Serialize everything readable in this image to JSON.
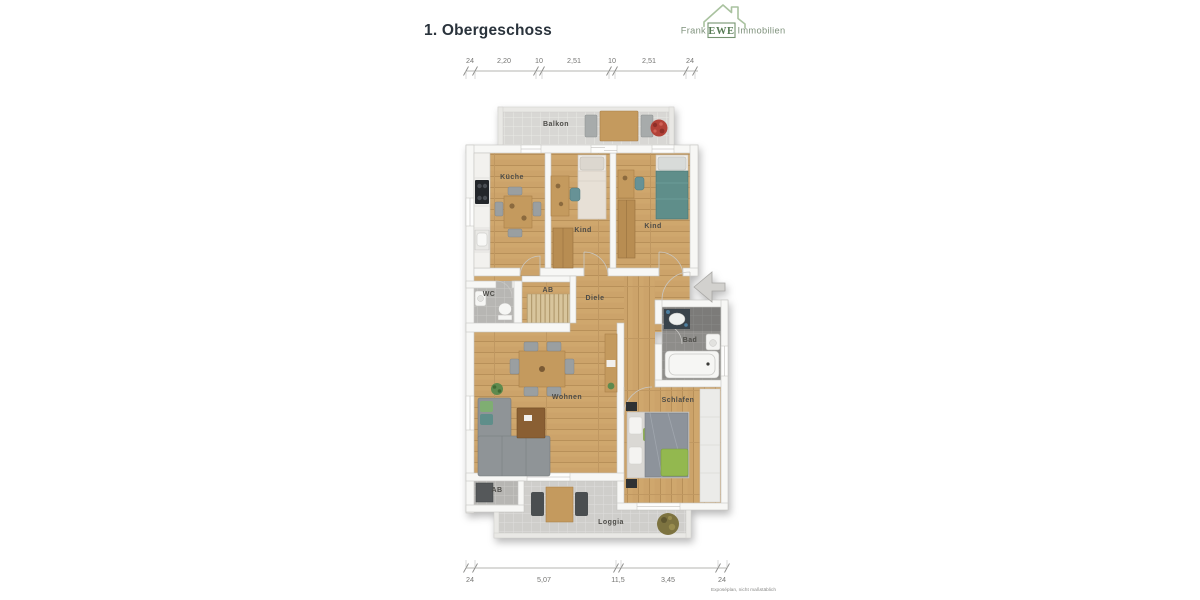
{
  "page": {
    "title": "1. Obergeschoss",
    "footnote": "Exposéplan, nicht maßstäblich"
  },
  "logo": {
    "prefix": "Frank",
    "mark": "EWE",
    "suffix": "Immobilien"
  },
  "plan": {
    "rooms": [
      {
        "id": "balkon",
        "label": "Balkon"
      },
      {
        "id": "kueche",
        "label": "Küche"
      },
      {
        "id": "kind-1",
        "label": "Kind"
      },
      {
        "id": "kind-2",
        "label": "Kind"
      },
      {
        "id": "wc",
        "label": "WC"
      },
      {
        "id": "ab-1",
        "label": "AB"
      },
      {
        "id": "diele",
        "label": "Diele"
      },
      {
        "id": "bad",
        "label": "Bad"
      },
      {
        "id": "wohnen",
        "label": "Wohnen"
      },
      {
        "id": "schlafen",
        "label": "Schlafen"
      },
      {
        "id": "ab-2",
        "label": "AB"
      },
      {
        "id": "loggia",
        "label": "Loggia"
      }
    ]
  },
  "dimensions": {
    "top": [
      "24",
      "2,20",
      "10",
      "2,51",
      "10",
      "2,51",
      "24"
    ],
    "bottom": [
      "24",
      "5,07",
      "11,5",
      "3,45",
      "24"
    ]
  },
  "colors": {
    "logo_green": "#557a52",
    "logo_text": "#7f927c",
    "house_outline": "#a9c29f",
    "wood_floor": "#cfa76d",
    "tile_light": "#d8d7d4",
    "tile_wet": "#8e8d8a",
    "label_text": "#4d4c48"
  }
}
